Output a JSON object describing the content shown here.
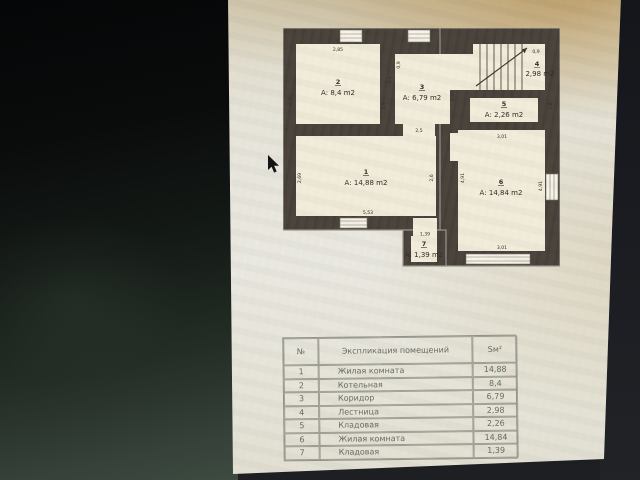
{
  "floor_plan": {
    "rooms": [
      {
        "number": "1",
        "area": "А: 14,88 m2"
      },
      {
        "number": "2",
        "area": "А: 8,4 m2"
      },
      {
        "number": "3",
        "area": "А: 6,79 m2"
      },
      {
        "number": "4",
        "area": "2,98 m2"
      },
      {
        "number": "5",
        "area": "А: 2,26 m2"
      },
      {
        "number": "6",
        "area": "А: 14,84 m2"
      },
      {
        "number": "7",
        "area": "А: 1,39 m2"
      }
    ],
    "dims": {
      "room2_top": "2,85",
      "room2_left": "2,95",
      "room2_right": "2,9",
      "room3_door": "0,9",
      "notch": "0,4",
      "room3_right": "2,84",
      "stairs_top": "0,9",
      "opening_1_3": "2,5",
      "room6_top": "3,01",
      "room5_right": "1,8",
      "room1_left": "2,69",
      "room1_bottom": "5,53",
      "room1_right": "2,6",
      "room6_left": "4,91",
      "room6_right": "4,91",
      "room6_bottom": "3,01",
      "room7_top": "1,39"
    }
  },
  "table": {
    "headers": [
      "№",
      "Экспликация помещений",
      "Sм²"
    ],
    "rows": [
      [
        "1",
        "Жилая комната",
        "14,88"
      ],
      [
        "2",
        "Котельная",
        "8,4"
      ],
      [
        "3",
        "Коридор",
        "6,79"
      ],
      [
        "4",
        "Лестница",
        "2,98"
      ],
      [
        "5",
        "Кладовая",
        "2,26"
      ],
      [
        "6",
        "Жилая комната",
        "14,84"
      ],
      [
        "7",
        "Кладовая",
        "1,39"
      ]
    ]
  }
}
